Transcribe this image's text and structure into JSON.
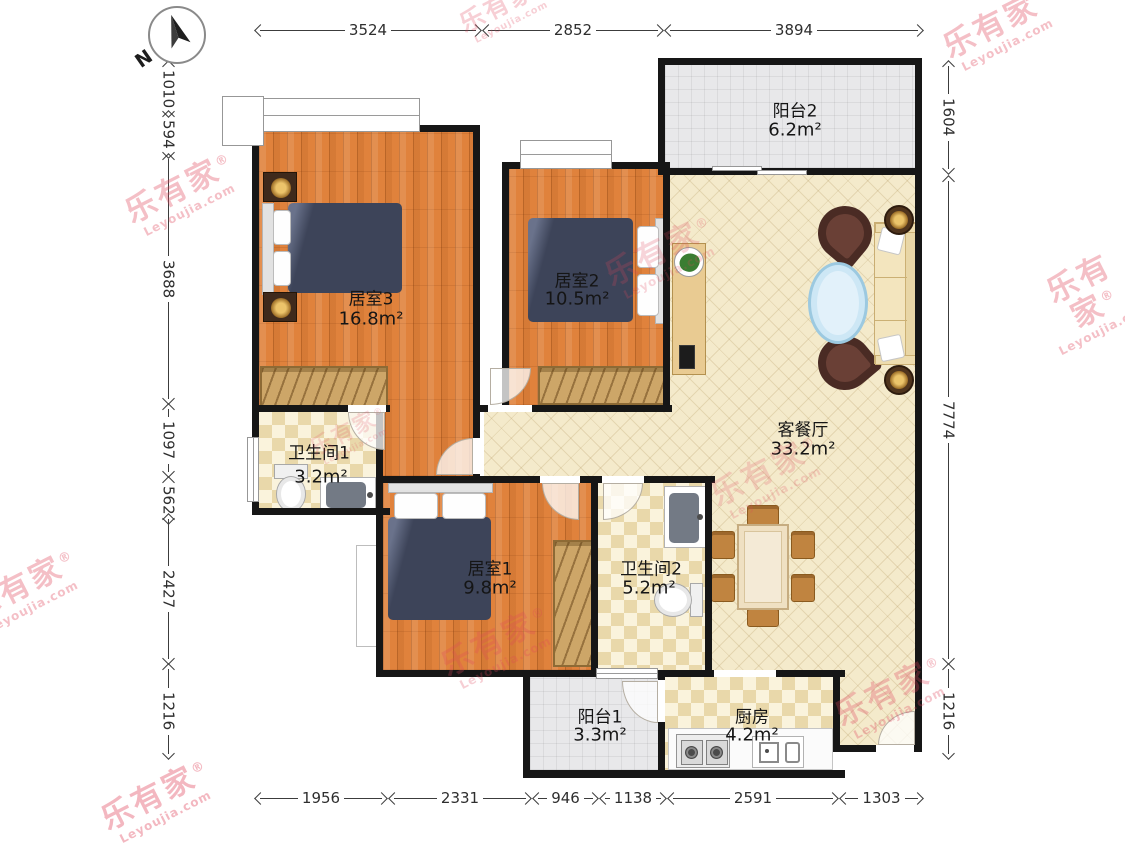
{
  "compass": {
    "north_label": "N"
  },
  "watermark": {
    "brand": "乐有家",
    "reg": "®",
    "domain": "Leyoujia.com"
  },
  "rooms": {
    "bedroom3": {
      "name": "居室3",
      "area": "16.8m²"
    },
    "bedroom2": {
      "name": "居室2",
      "area": "10.5m²"
    },
    "bedroom1": {
      "name": "居室1",
      "area": "9.8m²"
    },
    "bathroom1": {
      "name": "卫生间1",
      "area": "3.2m²"
    },
    "bathroom2": {
      "name": "卫生间2",
      "area": "5.2m²"
    },
    "living": {
      "name": "客餐厅",
      "area": "33.2m²"
    },
    "balcony2": {
      "name": "阳台2",
      "area": "6.2m²"
    },
    "balcony1": {
      "name": "阳台1",
      "area": "3.3m²"
    },
    "kitchen": {
      "name": "厨房",
      "area": "4.2m²"
    }
  },
  "dimensions": {
    "top": [
      "3524",
      "2852",
      "3894"
    ],
    "bottom": [
      "1956",
      "2331",
      "946",
      "1138",
      "2591",
      "1303"
    ],
    "left": [
      "1010",
      "594",
      "3688",
      "1097",
      "562",
      "2427",
      "1216"
    ],
    "right": [
      "1604",
      "7774",
      "1216"
    ]
  },
  "colors": {
    "wall": "#161616",
    "wood_floor": "#e0823c",
    "living_tile": "#f4eacb",
    "balcony_tile": "#e8e8ea",
    "bed": "#3d4459",
    "wardrobe": "#cda668",
    "watermark": "#e0455c"
  }
}
